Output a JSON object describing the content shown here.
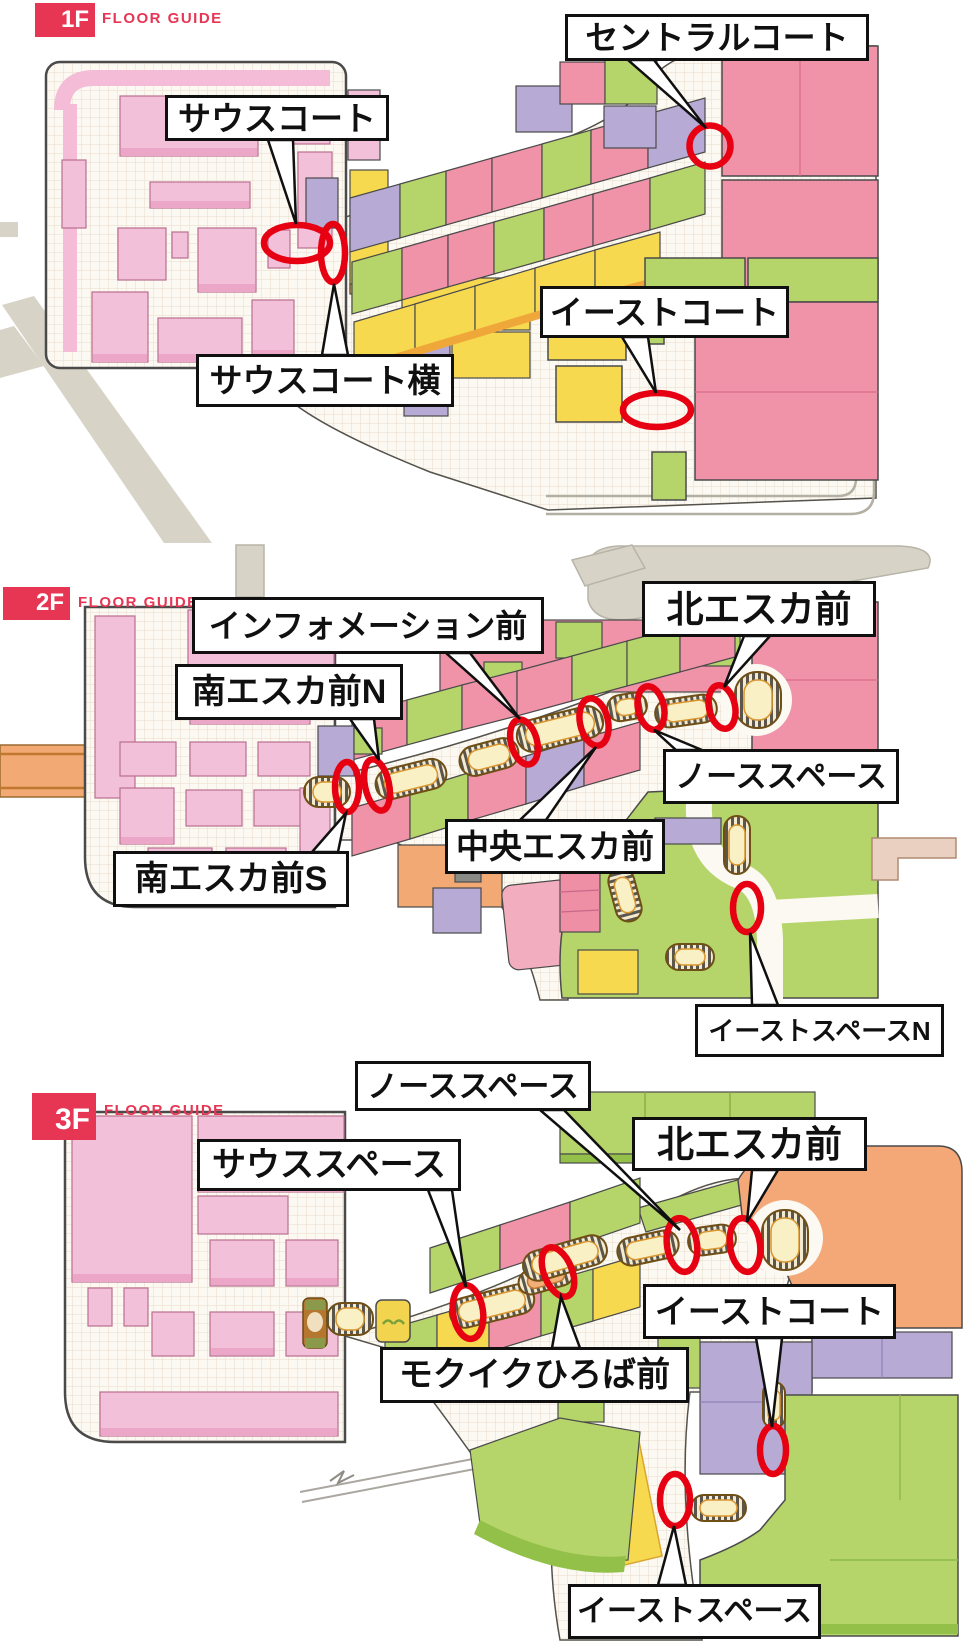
{
  "page": {
    "title": "FLOOR GUIDE"
  },
  "colors": {
    "accent": "#e73653",
    "marker_red": "#e60012",
    "store_pink": "#f093a9",
    "store_light_pink": "#f3c0da",
    "store_green": "#b5d56a",
    "store_yellow": "#f7d94f",
    "store_purple": "#b7abd6",
    "store_orange": "#f2a973",
    "escalator_cream": "#f9f0c5",
    "road_gray": "#d7d3c7",
    "bridge_beige": "#e9d0c1"
  },
  "floors": [
    {
      "badge": "1F",
      "guide_label": "FLOOR GUIDE",
      "locations": [
        {
          "name": "south-court",
          "text": "サウスコート"
        },
        {
          "name": "central-court",
          "text": "セントラルコート"
        },
        {
          "name": "east-court",
          "text": "イーストコート"
        },
        {
          "name": "south-court-side",
          "text": "サウスコート横"
        }
      ]
    },
    {
      "badge": "2F",
      "guide_label": "FLOOR GUIDE",
      "locations": [
        {
          "name": "information-front",
          "text": "インフォメーション前"
        },
        {
          "name": "north-escalator-front",
          "text": "北エスカ前"
        },
        {
          "name": "south-escalator-front-n",
          "text": "南エスカ前N"
        },
        {
          "name": "north-space",
          "text": "ノーススペース"
        },
        {
          "name": "central-escalator-front",
          "text": "中央エスカ前"
        },
        {
          "name": "south-escalator-front-s",
          "text": "南エスカ前S"
        },
        {
          "name": "east-space-n",
          "text": "イーストスペースN"
        }
      ]
    },
    {
      "badge": "3F",
      "guide_label": "FLOOR GUIDE",
      "locations": [
        {
          "name": "north-space",
          "text": "ノーススペース"
        },
        {
          "name": "north-escalator-front",
          "text": "北エスカ前"
        },
        {
          "name": "south-space",
          "text": "サウススペース"
        },
        {
          "name": "east-court",
          "text": "イーストコート"
        },
        {
          "name": "mokuiku-hiroba-front",
          "text": "モクイクひろば前"
        },
        {
          "name": "east-space",
          "text": "イーストスペース"
        }
      ]
    }
  ]
}
